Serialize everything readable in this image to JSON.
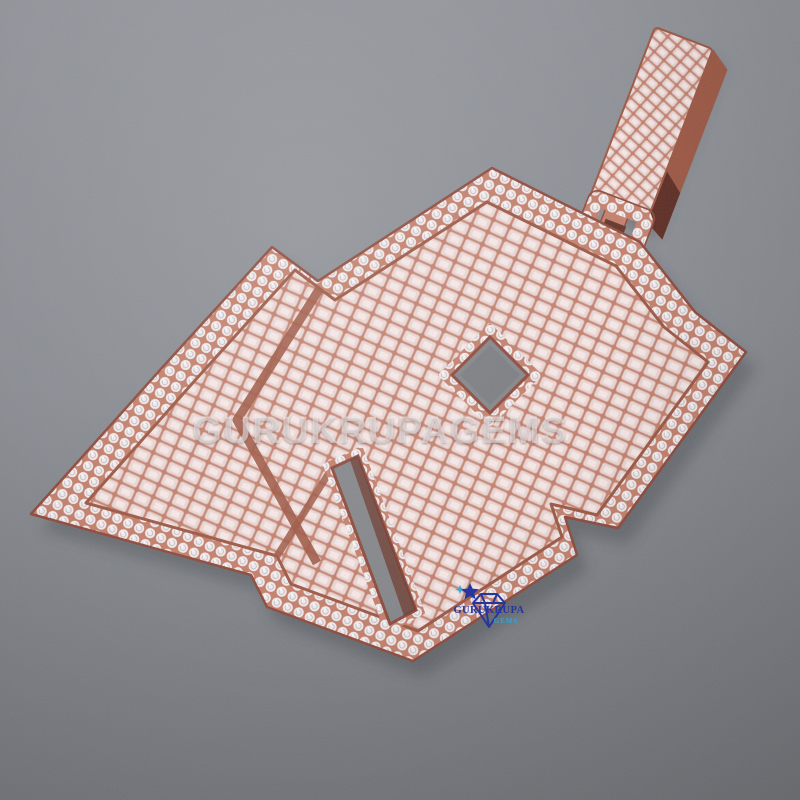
{
  "image": {
    "type": "product-photo",
    "subject": "Iced-out rose gold letter pendant with round pave and baguette stones, hanging bail at top right, on gray suede background"
  },
  "watermark": {
    "text": "GURUKRUPAGEMS"
  },
  "logo": {
    "brand": "GURUKRUPA",
    "sub": "GEMS"
  },
  "colors": {
    "background_top": "#92959b",
    "background_bottom": "#75787d",
    "rose_gold": "#c5806c",
    "rose_gold_dark": "#9e5844",
    "rose_gold_deep": "#8f4a3c",
    "stone_white": "#f2edef",
    "baguette_pink": "#ecd8d5",
    "logo_blue": "#2737a3",
    "logo_cyan": "#35a9dd",
    "watermark_white": "#ffffff"
  }
}
